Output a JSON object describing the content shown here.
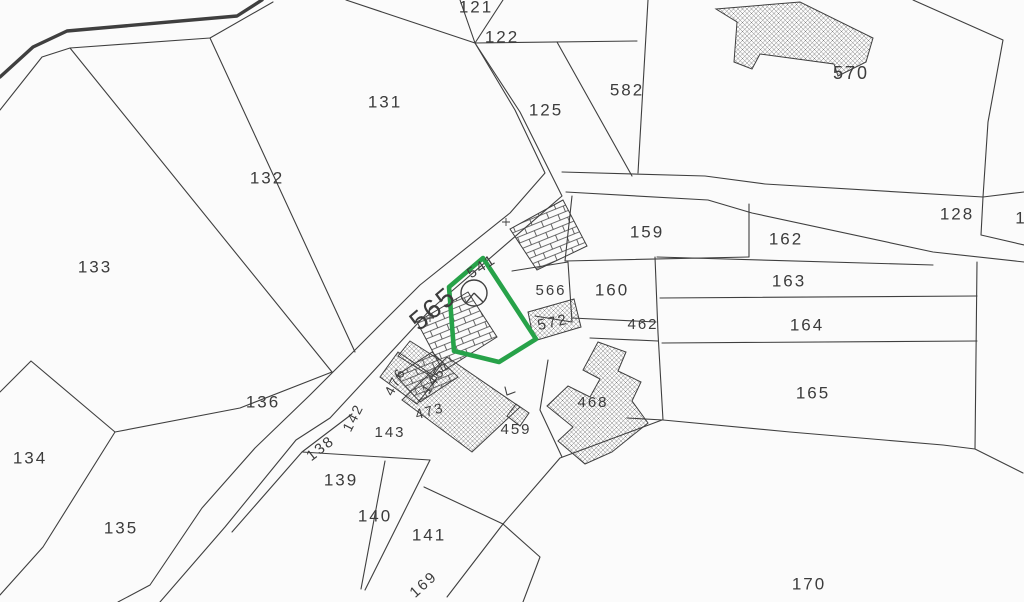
{
  "map": {
    "type": "cadastral-parcel-map",
    "highlighted_parcel": "541",
    "highlight_color": "#27a249",
    "line_color": "#3f3f3f",
    "text_color": "#3c3c3c",
    "background": "#fbfbfb",
    "labels": [
      {
        "text": "121",
        "x": 476,
        "y": 8,
        "rot": 0,
        "size": 17
      },
      {
        "text": "122",
        "x": 502,
        "y": 38,
        "rot": 0,
        "size": 17
      },
      {
        "text": "125",
        "x": 546,
        "y": 111,
        "rot": 0,
        "size": 17
      },
      {
        "text": "582",
        "x": 627,
        "y": 91,
        "rot": 0,
        "size": 17
      },
      {
        "text": "570",
        "x": 851,
        "y": 74,
        "rot": 0,
        "size": 18
      },
      {
        "text": "131",
        "x": 385,
        "y": 103,
        "rot": 0,
        "size": 17
      },
      {
        "text": "132",
        "x": 267,
        "y": 179,
        "rot": 0,
        "size": 17
      },
      {
        "text": "133",
        "x": 95,
        "y": 268,
        "rot": 0,
        "size": 17
      },
      {
        "text": "128",
        "x": 957,
        "y": 215,
        "rot": 0,
        "size": 17
      },
      {
        "text": "1",
        "x": 1021,
        "y": 219,
        "rot": 0,
        "size": 17
      },
      {
        "text": "159",
        "x": 647,
        "y": 233,
        "rot": 0,
        "size": 17
      },
      {
        "text": "162",
        "x": 786,
        "y": 240,
        "rot": 0,
        "size": 17
      },
      {
        "text": "163",
        "x": 789,
        "y": 282,
        "rot": 0,
        "size": 17
      },
      {
        "text": "164",
        "x": 807,
        "y": 326,
        "rot": 0,
        "size": 17
      },
      {
        "text": "165",
        "x": 813,
        "y": 394,
        "rot": 0,
        "size": 17
      },
      {
        "text": "160",
        "x": 612,
        "y": 291,
        "rot": 0,
        "size": 17
      },
      {
        "text": "566",
        "x": 551,
        "y": 291,
        "rot": 0,
        "size": 15
      },
      {
        "text": "462",
        "x": 643,
        "y": 325,
        "rot": 0,
        "size": 15
      },
      {
        "text": "572",
        "x": 553,
        "y": 323,
        "rot": -12,
        "size": 15
      },
      {
        "text": "565",
        "x": 434,
        "y": 310,
        "rot": -40,
        "size": 27
      },
      {
        "text": "541",
        "x": 482,
        "y": 267,
        "rot": -33,
        "size": 15
      },
      {
        "text": "476",
        "x": 396,
        "y": 382,
        "rot": -62,
        "size": 14
      },
      {
        "text": "145",
        "x": 434,
        "y": 381,
        "rot": -55,
        "size": 14
      },
      {
        "text": "473",
        "x": 430,
        "y": 412,
        "rot": -15,
        "size": 14
      },
      {
        "text": "143",
        "x": 390,
        "y": 433,
        "rot": 0,
        "size": 15
      },
      {
        "text": "459",
        "x": 516,
        "y": 430,
        "rot": 0,
        "size": 15
      },
      {
        "text": "468",
        "x": 593,
        "y": 403,
        "rot": 0,
        "size": 15
      },
      {
        "text": "136",
        "x": 263,
        "y": 403,
        "rot": 0,
        "size": 17
      },
      {
        "text": "138",
        "x": 321,
        "y": 449,
        "rot": -38,
        "size": 15
      },
      {
        "text": "142",
        "x": 354,
        "y": 418,
        "rot": -63,
        "size": 14
      },
      {
        "text": "139",
        "x": 341,
        "y": 481,
        "rot": 0,
        "size": 17
      },
      {
        "text": "134",
        "x": 30,
        "y": 459,
        "rot": 0,
        "size": 17
      },
      {
        "text": "135",
        "x": 121,
        "y": 529,
        "rot": 0,
        "size": 17
      },
      {
        "text": "140",
        "x": 375,
        "y": 517,
        "rot": 0,
        "size": 17
      },
      {
        "text": "141",
        "x": 429,
        "y": 536,
        "rot": 0,
        "size": 17
      },
      {
        "text": "169",
        "x": 424,
        "y": 585,
        "rot": -42,
        "size": 15
      },
      {
        "text": "170",
        "x": 809,
        "y": 585,
        "rot": 0,
        "size": 17
      }
    ],
    "symbols": [
      {
        "name": "well-circle-symbol",
        "x": 474,
        "y": 293,
        "r": 13
      }
    ],
    "highlighted_parcel_outline_points": "483,258 449,287 454,351 499,362 536,339"
  }
}
